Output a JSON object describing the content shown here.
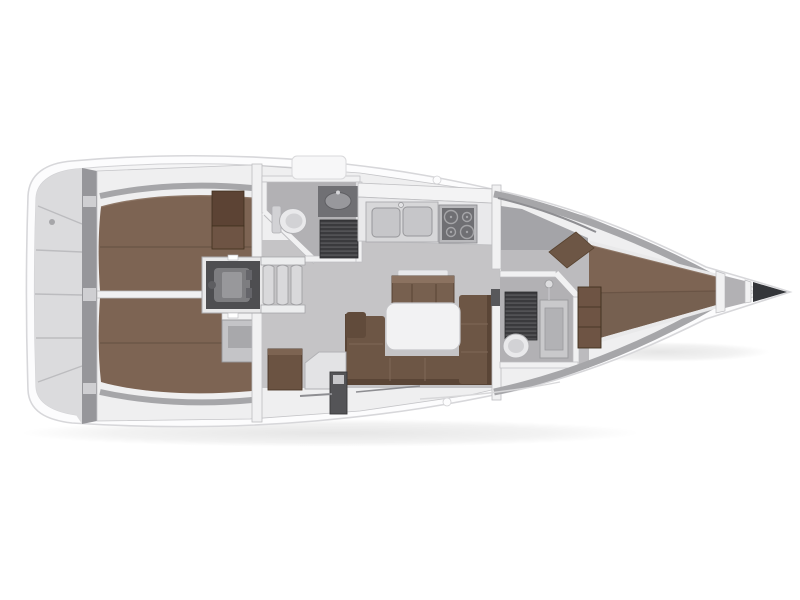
{
  "scene": {
    "description": "Top-down interior floor plan of a sailing yacht, bow pointing right",
    "view": "top-down",
    "bow_direction": "right",
    "components": [
      "hull",
      "stern-lockers",
      "aft-cabin-port",
      "aft-cabin-starboard",
      "engine-compartment",
      "companionway-steps",
      "aft-head",
      "galley",
      "salon",
      "nav-station",
      "forward-head",
      "forward-cabin",
      "v-berth",
      "anchor-locker"
    ]
  },
  "colors": {
    "background": "#ffffff",
    "hull": "#fcfcfd",
    "hullStroke": "#d7d7da",
    "deck": "#f4f4f5",
    "deckStroke": "#d2d2d5",
    "sternPanel": "#dbdbdd",
    "sternDivider": "#bcbcbf",
    "sternWall": "#96969a",
    "sternNotch": "#cfcfd2",
    "interiorWall": "#efeff0",
    "interiorStroke": "#c5c5c8",
    "sideWall": "#a6a6a9",
    "floor": "#c5c4c6",
    "corridorFloor": "#bcbbbe",
    "headFloor": "#b2b1b4",
    "shadedFloor": "#a4a4a8",
    "wall": "#f1f1f2",
    "wallStroke": "#bdbdc0",
    "berth": "#7d6453",
    "berthDark": "#766050",
    "berthSeam": "#6a5445",
    "berthEdge": "#8f7868",
    "settee": "#6d5645",
    "setteeBack": "#5a4536",
    "cushionSeam": "#7f6858",
    "armrest": "#614b3b",
    "sideboard": "#77604f",
    "sideboardTop": "#8b7260",
    "sideboardEdge": "#523d2d",
    "table": "#f2f2f3",
    "tableStroke": "#c6c6c9",
    "wardrobe": "#5c4334",
    "wardrobeMid": "#6e5444",
    "wardrobeEdge": "#40301f",
    "cabinetGrey": "#c4c4c7",
    "cabinetInner": "#a8a8ab",
    "cabinetEdge": "#96969a",
    "chartTable": "#6b5342",
    "chartTableTop": "#7d6452",
    "chartTableEdge": "#4b3828",
    "seatWhite": "#e3e3e5",
    "seatStroke": "#b2b2b5",
    "counter": "#e9e9eb",
    "counterStroke": "#bfbfc2",
    "locker": "#f3f3f4",
    "sinkUnit": "#d7d7d9",
    "sinkEdge": "#ababae",
    "basin": "#c6c6c9",
    "basinStroke": "#97979a",
    "stoveFrame": "#b9b9bc",
    "stovePanel": "#6f6f73",
    "burner": "#a5a5a8",
    "grate": "#3a3a3d",
    "grateSlat": "#57575b",
    "engineFrame": "#e8e8e9",
    "engineRoom": "#4e4e51",
    "engineBody": "#7d7d80",
    "engineDetail": "#98989b",
    "steps": "#d9d9db",
    "stepsStroke": "#a0a0a3",
    "stepsCap": "#ecedee",
    "toilet": "#e9e9eb",
    "toiletStroke": "#b0b0b3",
    "toiletSeat": "#d2d2d5",
    "vanity": "#c9c9cb",
    "vanityInner": "#b2b2b5",
    "vanityStroke": "#9b9b9e",
    "headCounter": "#707074",
    "headBasin": "#98989c",
    "anchorLocker": "#34363a",
    "bowLocker": "#b2b1b4",
    "windowLine": "#8e8e92",
    "deckDetail": "#d9d9db",
    "darkLocker": "#545457"
  }
}
